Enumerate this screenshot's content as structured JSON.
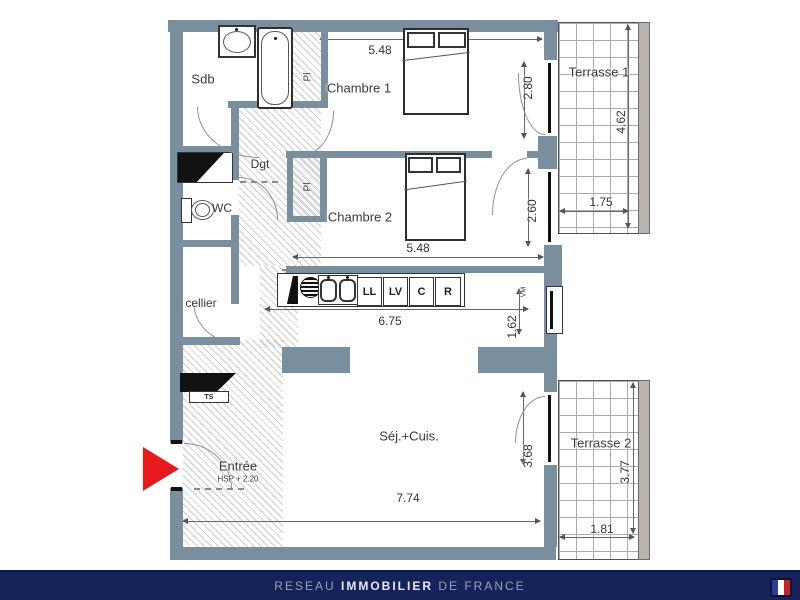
{
  "plan": {
    "rooms": {
      "sdb": "Sdb",
      "chambre1": "Chambre 1",
      "chambre2": "Chambre 2",
      "dgt": "Dgt",
      "wc": "WC",
      "cellier": "cellier",
      "sejour": "Séj.+Cuis.",
      "entree": "Entrée",
      "entree_note": "HSP + 2.20",
      "terrasse1": "Terrasse 1",
      "terrasse2": "Terrasse 2",
      "closet1": "Pl",
      "closet2": "Pl"
    },
    "appliances": {
      "washer": "LL",
      "dishwasher": "LV",
      "cooker": "C",
      "fridge": "R",
      "vent": "VM",
      "panel": "TS"
    },
    "dims": {
      "ch1_width": "5.48",
      "ch1_window": "2.80",
      "ch2_width": "5.48",
      "ch2_window": "2.60",
      "kitchen_width": "6.75",
      "kitchen_window": "1.62",
      "sej_width": "7.74",
      "sej_window": "3.68",
      "t1_depth": "4.62",
      "t1_width": "1.75",
      "t2_depth": "3.77",
      "t2_width": "1.81"
    },
    "colors": {
      "wall": "#7A8F9E",
      "entrance_arrow": "#E8191C",
      "footer_bg": "#16235A",
      "flag_blue": "#2A3C9B",
      "flag_red": "#C8202F"
    }
  },
  "footer": {
    "brand_pre": "RESEAU",
    "brand_main": "IMMOBILIER",
    "brand_post": "DE FRANCE"
  }
}
